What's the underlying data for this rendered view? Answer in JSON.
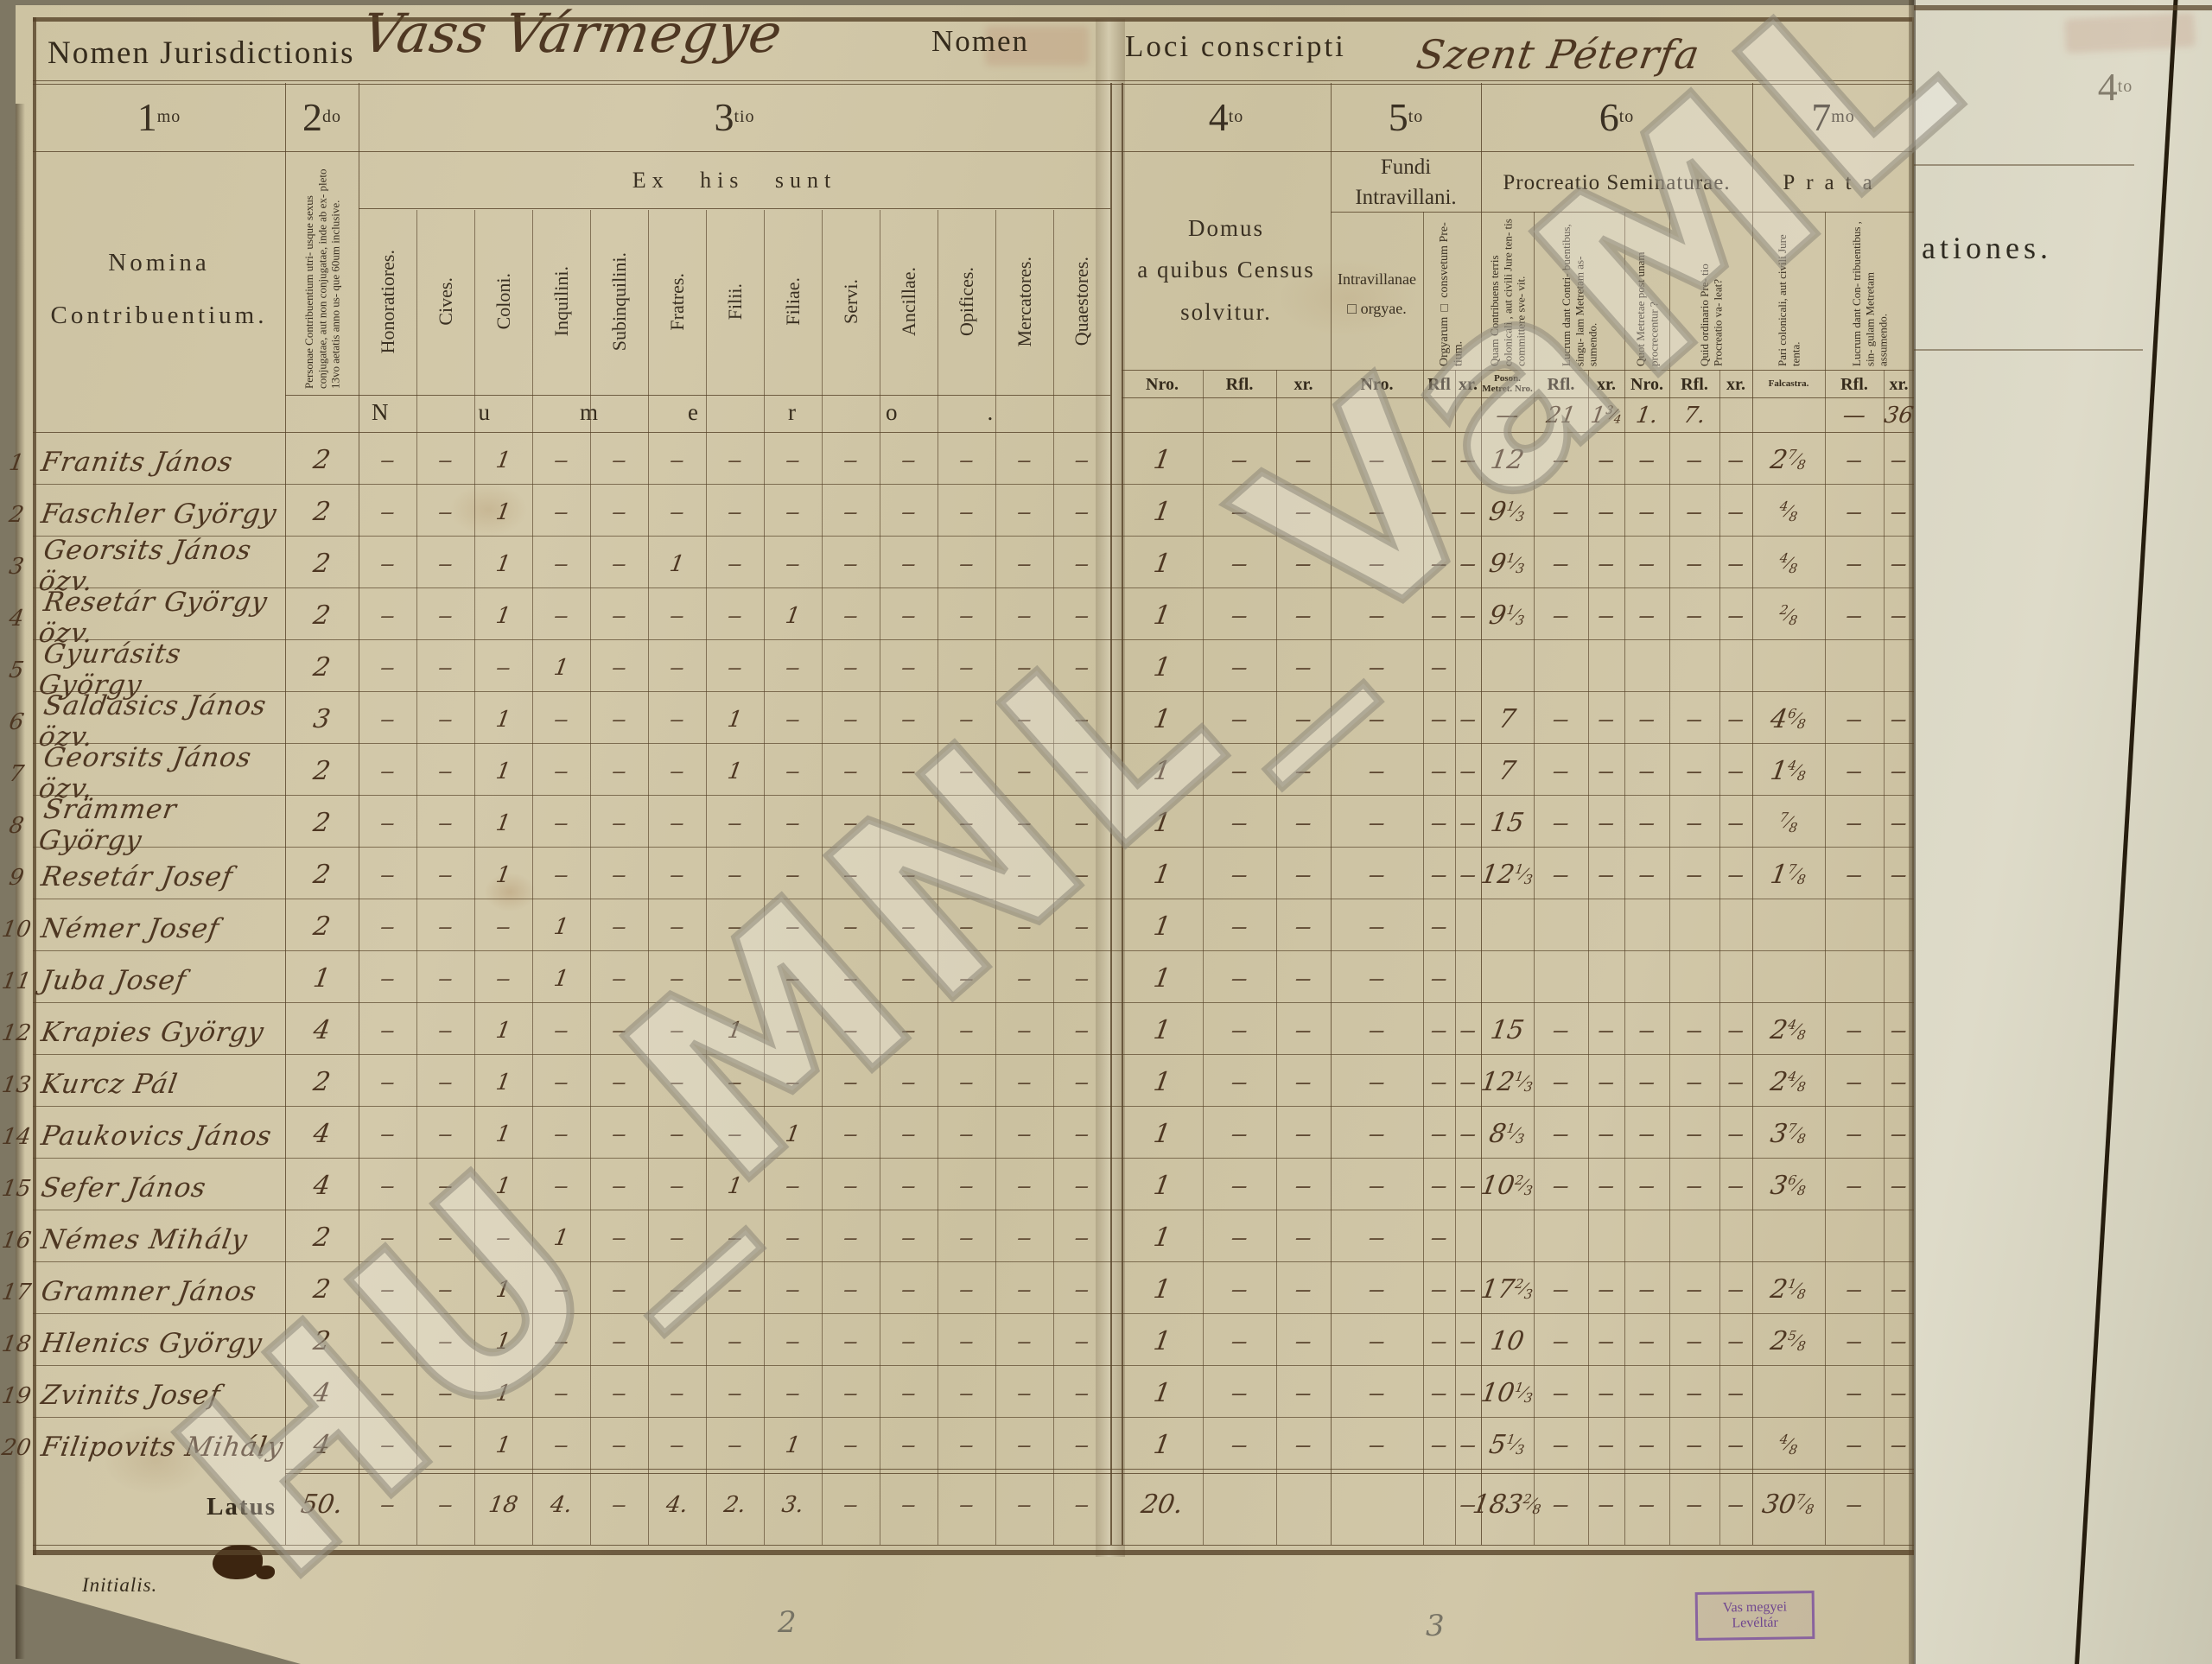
{
  "watermark": "HU_MNL_VaML",
  "header": {
    "jurisdiction_label": "Nomen Jurisdictionis",
    "jurisdiction_value": "Vass Vármegye",
    "nomen_label": "Nomen",
    "locus_label": "Loci conscripti",
    "locus_value": "Szent Péterfa"
  },
  "columns": {
    "c1": {
      "num": "1",
      "sup": "mo",
      "title": "Nomina\nContribuentium."
    },
    "c2": {
      "num": "2",
      "sup": "do",
      "desc": "Personae Contribuentium utri- usque sexus conjugatae, aut non conjugatae, inde ab ex- pleto 13vo aetatis anno us- que 60um inclusive."
    },
    "c3": {
      "num": "3",
      "sup": "tio",
      "title": "Ex his sunt",
      "subs": [
        "Honoratiores.",
        "Cives.",
        "Coloni.",
        "Inquilini.",
        "Subinquilini.",
        "Fratres.",
        "Filii.",
        "Filiae.",
        "Servi.",
        "Ancillae.",
        "Opifices.",
        "Mercatores.",
        "Quaestores."
      ],
      "numero": "Numero."
    },
    "c4": {
      "num": "4",
      "sup": "to",
      "title": "Domus\na quibus Census\nsolvitur."
    },
    "c5": {
      "num": "5",
      "sup": "to",
      "title": "Fundi\nIntravillani.",
      "sub1": "Intravillanae\n□ orgyae.",
      "sub2": "Orgyarum □ consvetum Pre- tium."
    },
    "c6": {
      "num": "6",
      "sup": "to",
      "title": "Procreatio Seminaturae.",
      "rot1": "Quam Contribuens terris colonicali , aut civili Jure ten- tis committere sve- vit.",
      "rot2": "Lucrum dant Contri- buentibus, singu- lam Metretam as- sumendo.",
      "rot3": "Quot Metretae post unam procrecentur ?",
      "rot4": "Quid ordinario Pre- tio Procreatio va- leat?"
    },
    "c7": {
      "num": "7",
      "sup": "mo",
      "title": "Prata",
      "rot1": "Pari colonicali, aut civili Jure tenta.",
      "rot2": "Lucrum dant Con- tribuentibus , sin- gulam Metretam assumendo."
    },
    "obs_fragment": "ationes.",
    "obs_colnum": "4",
    "obs_colnum_sup": "to"
  },
  "subheader_right": [
    "Nro.",
    "Rfl.",
    "xr.",
    "Nro.",
    "Rfl",
    "xr.",
    "Poson. Metret. Nro.",
    "Rfl.",
    "xr.",
    "Nro.",
    "Rfl.",
    "xr.",
    "Falcastra.",
    "Rfl.",
    "xr."
  ],
  "price_row": {
    "right": [
      "",
      "",
      "",
      "",
      "",
      "",
      "—",
      "21",
      "1|3/4",
      "1.",
      "7.",
      "",
      "",
      "—",
      "36"
    ]
  },
  "rows": [
    {
      "n": "1",
      "name": "Franits János",
      "p2": "2",
      "left": [
        "-",
        "-",
        "1",
        "-",
        "-",
        "-",
        "-",
        "-",
        "-",
        "-",
        "-",
        "-",
        "-"
      ],
      "right": [
        "1",
        "-",
        "-",
        "-",
        "-",
        "-",
        "12",
        "-",
        "-",
        "-",
        "-",
        "-",
        "2|7/8",
        "-",
        "-"
      ]
    },
    {
      "n": "2",
      "name": "Faschler György",
      "p2": "2",
      "left": [
        "-",
        "-",
        "1",
        "-",
        "-",
        "-",
        "-",
        "-",
        "-",
        "-",
        "-",
        "-",
        "-"
      ],
      "right": [
        "1",
        "-",
        "-",
        "-",
        "-",
        "-",
        "9|1/3",
        "-",
        "-",
        "-",
        "-",
        "-",
        "|4/8",
        "-",
        "-"
      ]
    },
    {
      "n": "3",
      "name": "Georsits János özv.",
      "p2": "2",
      "left": [
        "-",
        "-",
        "1",
        "-",
        "-",
        "1",
        "-",
        "-",
        "-",
        "-",
        "-",
        "-",
        "-"
      ],
      "right": [
        "1",
        "-",
        "-",
        "-",
        "-",
        "-",
        "9|1/3",
        "-",
        "-",
        "-",
        "-",
        "-",
        "|4/8",
        "-",
        "-"
      ]
    },
    {
      "n": "4",
      "name": "Resetár György özv.",
      "p2": "2",
      "left": [
        "-",
        "-",
        "1",
        "-",
        "-",
        "-",
        "-",
        "1",
        "-",
        "-",
        "-",
        "-",
        "-"
      ],
      "right": [
        "1",
        "-",
        "-",
        "-",
        "-",
        "-",
        "9|1/3",
        "-",
        "-",
        "-",
        "-",
        "-",
        "|2/8",
        "-",
        "-"
      ]
    },
    {
      "n": "5",
      "name": "Gyurásits György",
      "p2": "2",
      "left": [
        "-",
        "-",
        "-",
        "1",
        "-",
        "-",
        "-",
        "-",
        "-",
        "-",
        "-",
        "-",
        "-"
      ],
      "right": [
        "1",
        "-",
        "-",
        "-",
        "-",
        "",
        "",
        "",
        "",
        "",
        "",
        "",
        "",
        "",
        ""
      ]
    },
    {
      "n": "6",
      "name": "Saldasics János özv.",
      "p2": "3",
      "left": [
        "-",
        "-",
        "1",
        "-",
        "-",
        "-",
        "1",
        "-",
        "-",
        "-",
        "-",
        "-",
        "-"
      ],
      "right": [
        "1",
        "-",
        "-",
        "-",
        "-",
        "-",
        "7",
        "-",
        "-",
        "-",
        "-",
        "-",
        "4|6/8",
        "-",
        "-"
      ]
    },
    {
      "n": "7",
      "name": "Georsits János özv.",
      "p2": "2",
      "left": [
        "-",
        "-",
        "1",
        "-",
        "-",
        "-",
        "1",
        "-",
        "-",
        "-",
        "-",
        "-",
        "-"
      ],
      "right": [
        "1",
        "-",
        "-",
        "-",
        "-",
        "-",
        "7",
        "-",
        "-",
        "-",
        "-",
        "-",
        "1|4/8",
        "-",
        "-"
      ]
    },
    {
      "n": "8",
      "name": "Srämmer György",
      "p2": "2",
      "left": [
        "-",
        "-",
        "1",
        "-",
        "-",
        "-",
        "-",
        "-",
        "-",
        "-",
        "-",
        "-",
        "-"
      ],
      "right": [
        "1",
        "-",
        "-",
        "-",
        "-",
        "-",
        "15",
        "-",
        "-",
        "-",
        "-",
        "-",
        "|7/8",
        "-",
        "-"
      ]
    },
    {
      "n": "9",
      "name": "Resetár Josef",
      "p2": "2",
      "left": [
        "-",
        "-",
        "1",
        "-",
        "-",
        "-",
        "-",
        "-",
        "-",
        "-",
        "-",
        "-",
        "-"
      ],
      "right": [
        "1",
        "-",
        "-",
        "-",
        "-",
        "-",
        "12|1/3",
        "-",
        "-",
        "-",
        "-",
        "-",
        "1|7/8",
        "-",
        "-"
      ]
    },
    {
      "n": "10",
      "name": "Némer Josef",
      "p2": "2",
      "left": [
        "-",
        "-",
        "-",
        "1",
        "-",
        "-",
        "-",
        "-",
        "-",
        "-",
        "-",
        "-",
        "-"
      ],
      "right": [
        "1",
        "-",
        "-",
        "-",
        "-",
        "",
        "",
        "",
        "",
        "",
        "",
        "",
        "",
        "",
        ""
      ]
    },
    {
      "n": "11",
      "name": "Juba Josef",
      "p2": "1",
      "left": [
        "-",
        "-",
        "-",
        "1",
        "-",
        "-",
        "-",
        "-",
        "-",
        "-",
        "-",
        "-",
        "-"
      ],
      "right": [
        "1",
        "-",
        "-",
        "-",
        "-",
        "",
        "",
        "",
        "",
        "",
        "",
        "",
        "",
        "",
        ""
      ]
    },
    {
      "n": "12",
      "name": "Krapies György",
      "p2": "4",
      "left": [
        "-",
        "-",
        "1",
        "-",
        "-",
        "-",
        "1",
        "-",
        "-",
        "-",
        "-",
        "-",
        "-"
      ],
      "right": [
        "1",
        "-",
        "-",
        "-",
        "-",
        "-",
        "15",
        "-",
        "-",
        "-",
        "-",
        "-",
        "2|4/8",
        "-",
        "-"
      ]
    },
    {
      "n": "13",
      "name": "Kurcz Pál",
      "p2": "2",
      "left": [
        "-",
        "-",
        "1",
        "-",
        "-",
        "-",
        "-",
        "-",
        "-",
        "-",
        "-",
        "-",
        "-"
      ],
      "right": [
        "1",
        "-",
        "-",
        "-",
        "-",
        "-",
        "12|1/3",
        "-",
        "-",
        "-",
        "-",
        "-",
        "2|4/8",
        "-",
        "-"
      ]
    },
    {
      "n": "14",
      "name": "Paukovics János",
      "p2": "4",
      "left": [
        "-",
        "-",
        "1",
        "-",
        "-",
        "-",
        "-",
        "1",
        "-",
        "-",
        "-",
        "-",
        "-"
      ],
      "right": [
        "1",
        "-",
        "-",
        "-",
        "-",
        "-",
        "8|1/3",
        "-",
        "-",
        "-",
        "-",
        "-",
        "3|7/8",
        "-",
        "-"
      ]
    },
    {
      "n": "15",
      "name": "Sefer János",
      "p2": "4",
      "left": [
        "-",
        "-",
        "1",
        "-",
        "-",
        "-",
        "1",
        "-",
        "-",
        "-",
        "-",
        "-",
        "-"
      ],
      "right": [
        "1",
        "-",
        "-",
        "-",
        "-",
        "-",
        "10|2/3",
        "-",
        "-",
        "-",
        "-",
        "-",
        "3|6/8",
        "-",
        "-"
      ]
    },
    {
      "n": "16",
      "name": "Némes Mihály",
      "p2": "2",
      "left": [
        "-",
        "-",
        "-",
        "1",
        "-",
        "-",
        "-",
        "-",
        "-",
        "-",
        "-",
        "-",
        "-"
      ],
      "right": [
        "1",
        "-",
        "-",
        "-",
        "-",
        "",
        "",
        "",
        "",
        "",
        "",
        "",
        "",
        "",
        ""
      ]
    },
    {
      "n": "17",
      "name": "Gramner János",
      "p2": "2",
      "left": [
        "-",
        "-",
        "1",
        "-",
        "-",
        "-",
        "-",
        "-",
        "-",
        "-",
        "-",
        "-",
        "-"
      ],
      "right": [
        "1",
        "-",
        "-",
        "-",
        "-",
        "-",
        "17|2/3",
        "-",
        "-",
        "-",
        "-",
        "-",
        "2|1/8",
        "-",
        "-"
      ]
    },
    {
      "n": "18",
      "name": "Hlenics György",
      "p2": "2",
      "left": [
        "-",
        "-",
        "1",
        "-",
        "-",
        "-",
        "-",
        "-",
        "-",
        "-",
        "-",
        "-",
        "-"
      ],
      "right": [
        "1",
        "-",
        "-",
        "-",
        "-",
        "-",
        "10",
        "-",
        "-",
        "-",
        "-",
        "-",
        "2|5/8",
        "-",
        "-"
      ]
    },
    {
      "n": "19",
      "name": "Zvinits Josef",
      "p2": "4",
      "left": [
        "-",
        "-",
        "1",
        "-",
        "-",
        "-",
        "-",
        "-",
        "-",
        "-",
        "-",
        "-",
        "-"
      ],
      "right": [
        "1",
        "-",
        "-",
        "-",
        "-",
        "-",
        "10|1/3",
        "-",
        "-",
        "-",
        "-",
        "-",
        "",
        "-",
        "-"
      ]
    },
    {
      "n": "20",
      "name": "Filipovits Mihály",
      "p2": "4",
      "left": [
        "-",
        "-",
        "1",
        "-",
        "-",
        "-",
        "-",
        "1",
        "-",
        "-",
        "-",
        "-",
        "-"
      ],
      "right": [
        "1",
        "-",
        "-",
        "-",
        "-",
        "-",
        "5|1/3",
        "-",
        "-",
        "-",
        "-",
        "-",
        "|4/8",
        "-",
        "-"
      ]
    }
  ],
  "latus": {
    "label": "Latus",
    "p2": "50.",
    "left": [
      "-",
      "-",
      "18",
      "4.",
      "-",
      "4.",
      "2.",
      "3.",
      "-",
      "-",
      "-",
      "-",
      "-"
    ],
    "right": [
      "20.",
      "",
      "",
      "",
      "",
      "-",
      "183|2/8",
      "-",
      "-",
      "-",
      "-",
      "-",
      "30|7/8",
      "-",
      ""
    ]
  },
  "footer": {
    "initialis": "Initialis.",
    "stamp_line1": "Vas megyei",
    "stamp_line2": "Levéltár",
    "pencil_2": "2",
    "pencil_3": "3"
  },
  "colors": {
    "ink": "#4e3722",
    "print": "#352b1c",
    "paper": "#cdc3a2",
    "paper_right": "#d9d6c3",
    "stamp": "#6f3e9e"
  }
}
